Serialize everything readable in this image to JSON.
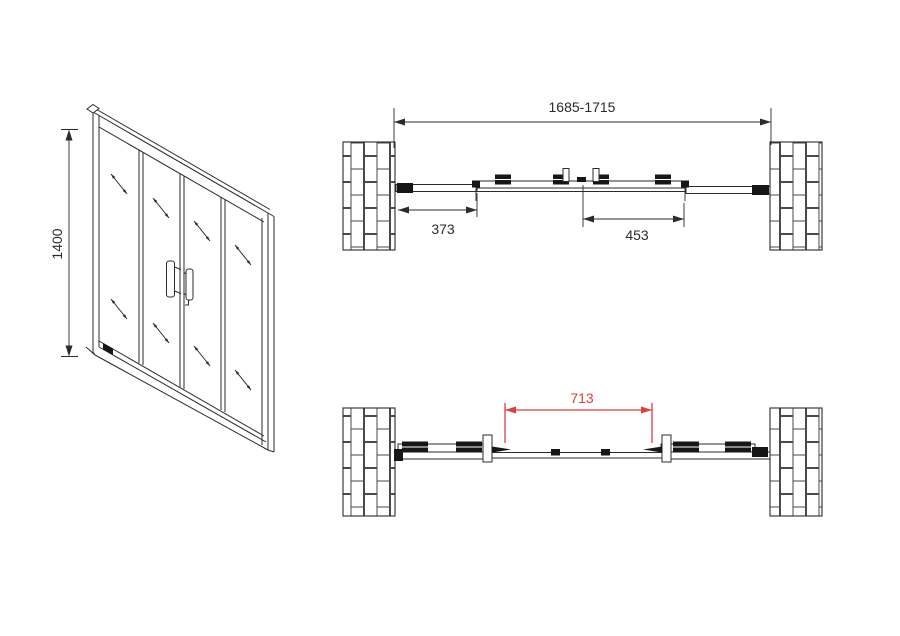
{
  "colors": {
    "line": "#2b2b2b",
    "red": "#d9403f",
    "dark": "#161616",
    "wallline": "#4a4a4a",
    "bg": "#ffffff"
  },
  "views": {
    "front": {
      "height_label": "1400"
    },
    "plan_closed": {
      "total_width_label": "1685-1715",
      "left_fixed_panel_label": "373",
      "right_span_label": "453"
    },
    "plan_open": {
      "opening_width_label": "713"
    }
  }
}
